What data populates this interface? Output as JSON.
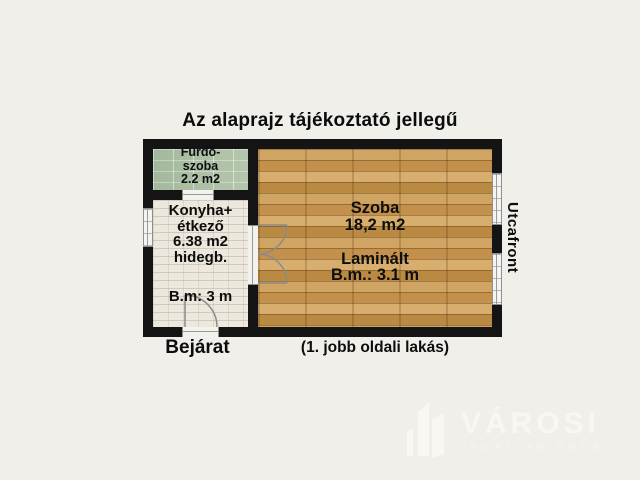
{
  "title": "Az alaprajz tájékoztató jellegű",
  "rooms": {
    "bathroom": {
      "line1": "Fürdő-",
      "line2": "szoba",
      "line3": "2.2 m2"
    },
    "kitchen": {
      "line1": "Konyha+",
      "line2": "étkező",
      "line3": "6.38 m2",
      "line4": "hidegb.",
      "ceiling": "B.m: 3 m"
    },
    "living": {
      "name": "Szoba",
      "area": "18,2 m2",
      "flooring": "Laminált",
      "ceiling": "B.m.: 3.1 m"
    }
  },
  "labels": {
    "street": "Utcafront",
    "entrance": "Bejárat",
    "note": "(1. jobb oldali lakás)"
  },
  "watermark": {
    "name": "VÁROSI",
    "subtitle": "INGATLANIRODA"
  },
  "colors": {
    "background": "#f0efea",
    "wall": "#141414",
    "bathroom_floor": "#a9bda3",
    "kitchen_floor": "#ece8dd",
    "wood_floor": "#c6985a",
    "watermark": "#f8f7f2"
  }
}
